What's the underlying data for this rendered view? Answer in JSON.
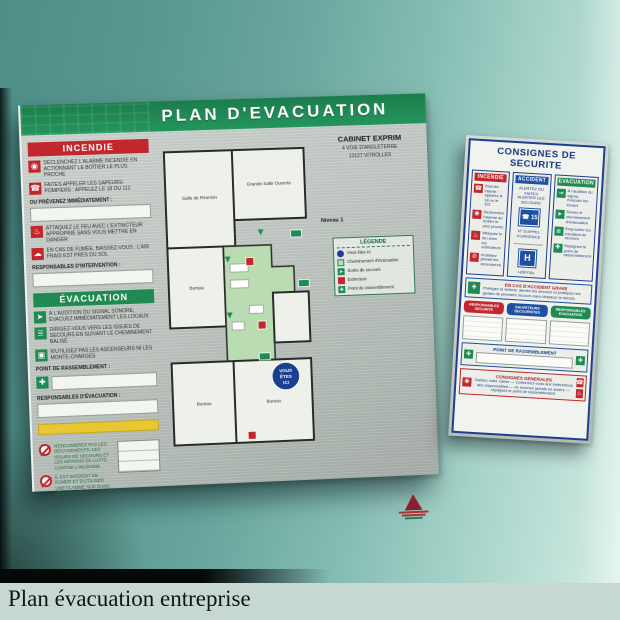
{
  "caption": {
    "title": "Plan évacuation entreprise"
  },
  "colors": {
    "wall_teal": "#6aa79e",
    "board_green": "#1f8a52",
    "alert_red": "#c1272d",
    "consignes_blue": "#1e3f90",
    "highlight_yellow": "#e7c832"
  },
  "evacuation_board": {
    "title": "PLAN D'EVACUATION",
    "incendie": {
      "header": "INCENDIE",
      "items": [
        "DÉCLENCHEZ L'ALARME INCENDIE EN ACTIONNANT LE BOÎTIER LE PLUS PROCHE",
        "FAITES APPELER LES SAPEURS-POMPIERS : APPELEZ LE 18 OU 112",
        "ATTAQUEZ LE FEU AVEC L'EXTINCTEUR APPROPRIÉ SANS VOUS METTRE EN DANGER",
        "EN CAS DE FUMÉE, BAISSEZ-VOUS : L'AIR FRAIS EST PRÈS DU SOL"
      ],
      "prevenez_label": "OU PRÉVENEZ IMMÉDIATEMENT :",
      "responsables_label": "RESPONSABLES D'INTERVENTION :"
    },
    "evacuation": {
      "header": "ÉVACUATION",
      "items": [
        "À L'AUDITION DU SIGNAL SONORE, ÉVACUEZ IMMÉDIATEMENT LES LOCAUX",
        "DIRIGEZ-VOUS VERS LES ISSUES DE SECOURS EN SUIVANT LE CHEMINEMENT BALISÉ",
        "N'UTILISEZ PAS LES ASCENSEURS NI LES MONTE-CHARGES"
      ],
      "point_label": "POINT DE RASSEMBLEMENT :",
      "responsables_label": "RESPONSABLES D'ÉVACUATION :"
    },
    "interdictions": [
      "N'ENCOMBREZ PAS LES DÉGAGEMENTS, LES ISSUES DE SECOURS ET LES MOYENS DE LUTTE CONTRE L'INCENDIE",
      "IL EST INTERDIT DE FUMER ET D'UTILISER UNE FLAMME NUE DANS LES LOCAUX"
    ],
    "address": {
      "name": "CABINET EXPRIM",
      "line1": "4 VOIE D'ANGLETERRE",
      "line2": "13127 VITROLLES"
    },
    "niveau_label": "Niveau 1",
    "legende": {
      "title": "LÉGENDE",
      "items": [
        "Vous êtes ici",
        "Cheminement d'évacuation",
        "Sortie de secours",
        "Extincteur",
        "Point de rassemblement"
      ]
    },
    "plan": {
      "rooms": [
        "Salle de Réunion",
        "Grande Salle Ouverte",
        "Bureau",
        "Bureau",
        "Bureau"
      ],
      "you_are_here_1": "VOUS",
      "you_are_here_2": "ÊTES",
      "you_are_here_3": "ICI"
    }
  },
  "consignes_board": {
    "title": "CONSIGNES DE SECURITE",
    "incendie": {
      "header": "INCENDIE",
      "items": [
        "Donnez l'alerte : appelez le 18 ou le 112",
        "Déclenchez l'alarme au boîtier le plus proche",
        "Attaquez le feu avec les extincteurs",
        "N'utilisez jamais les ascenseurs"
      ]
    },
    "accident": {
      "header": "ACCIDENT",
      "intro": "ALERTEZ OU FAITES ALERTER LES SECOURS",
      "samu_number": "☎ 15",
      "urgence_label": "N° D'APPEL D'URGENCE",
      "hopital_letter": "H",
      "hopital_label": "HÔPITAL"
    },
    "evacuation": {
      "header": "EVACUATION",
      "items": [
        "À l'audition du signal, évacuez les locaux",
        "Suivez le cheminement d'évacuation",
        "Empruntez les escaliers de secours",
        "Rejoignez le point de rassemblement"
      ]
    },
    "middle": {
      "title": "EN CAS D'ACCIDENT GRAVE",
      "text": "Protégez la victime, alertez les secours et pratiquez les gestes de premiers secours sans déplacer le blessé."
    },
    "pills": [
      "RESPONSABLES SECURITE",
      "SAUVETEURS SECOURISTES",
      "RESPONSABLES EVACUATION"
    ],
    "rassemblement_label": "POINT DE RASSEMBLEMENT",
    "generales": {
      "title": "CONSIGNES GENERALES",
      "text": "Gardez votre calme — conformez-vous aux instructions des responsables — ne revenez jamais en arrière — rejoignez le point de rassemblement"
    }
  }
}
